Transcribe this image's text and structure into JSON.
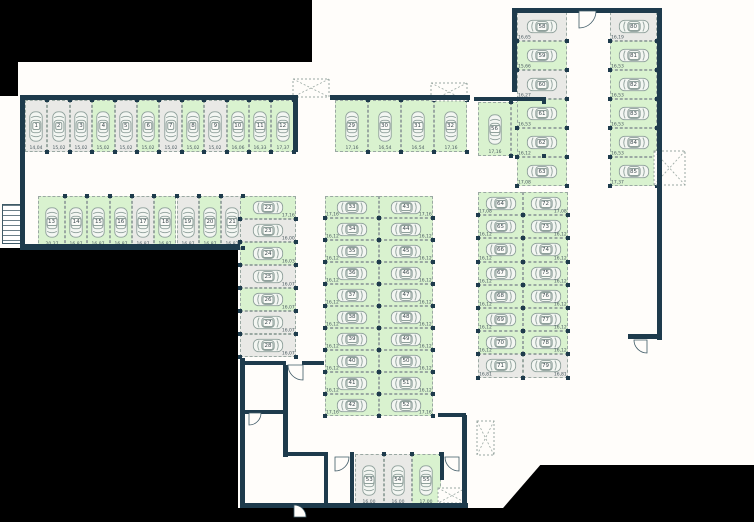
{
  "title": "Parking garage floor plan",
  "colors": {
    "available_fill": "#d9f2cf",
    "taken_fill": "#e9e9e6",
    "wall": "#1e3b4c",
    "background": "#000000",
    "floor": "#fffdfa",
    "car_outline": "#8fa09b"
  },
  "blocks": [
    {
      "id": "row-top-left",
      "spaces": [
        {
          "n": "1",
          "dim": "14,04",
          "state": "gray"
        },
        {
          "n": "2",
          "dim": "15,02",
          "state": "gray"
        },
        {
          "n": "3",
          "dim": "15,02",
          "state": "gray"
        },
        {
          "n": "4",
          "dim": "15,02",
          "state": "green"
        },
        {
          "n": "5",
          "dim": "15,02",
          "state": "gray"
        },
        {
          "n": "6",
          "dim": "15,02",
          "state": "green"
        },
        {
          "n": "7",
          "dim": "15,02",
          "state": "gray"
        },
        {
          "n": "8",
          "dim": "15,02",
          "state": "green"
        },
        {
          "n": "9",
          "dim": "15,02",
          "state": "gray"
        },
        {
          "n": "10",
          "dim": "16,06",
          "state": "green"
        },
        {
          "n": "11",
          "dim": "16,33",
          "state": "green"
        },
        {
          "n": "12",
          "dim": "17,37",
          "state": "green"
        }
      ]
    },
    {
      "id": "row-2",
      "spaces": [
        {
          "n": "13",
          "dim": "20,27",
          "state": "green"
        },
        {
          "n": "14",
          "dim": "16,87",
          "state": "green"
        },
        {
          "n": "15",
          "dim": "16,87",
          "state": "green"
        },
        {
          "n": "16",
          "dim": "16,87",
          "state": "green"
        },
        {
          "n": "17",
          "dim": "16,87",
          "state": "gray"
        },
        {
          "n": "18",
          "dim": "16,87",
          "state": "green"
        },
        {
          "n": "19",
          "dim": "16,87",
          "state": "gray"
        },
        {
          "n": "20",
          "dim": "16,87",
          "state": "green"
        },
        {
          "n": "21",
          "dim": "16,87",
          "state": "gray"
        }
      ]
    },
    {
      "id": "col-left",
      "spaces": [
        {
          "n": "22",
          "dim": "17,16",
          "state": "green"
        },
        {
          "n": "23",
          "dim": "16,00",
          "state": "gray"
        },
        {
          "n": "24",
          "dim": "16,03",
          "state": "green"
        },
        {
          "n": "25",
          "dim": "16,07",
          "state": "gray"
        },
        {
          "n": "26",
          "dim": "16,07",
          "state": "green"
        },
        {
          "n": "27",
          "dim": "16,07",
          "state": "gray"
        },
        {
          "n": "28",
          "dim": "16,07",
          "state": "gray"
        }
      ]
    },
    {
      "id": "row-mid",
      "spaces": [
        {
          "n": "29",
          "dim": "17,16",
          "state": "green"
        },
        {
          "n": "30",
          "dim": "16,54",
          "state": "green"
        },
        {
          "n": "31",
          "dim": "16,54",
          "state": "green"
        },
        {
          "n": "32",
          "dim": "17,16",
          "state": "green"
        }
      ]
    },
    {
      "id": "col-center-a",
      "spaces": [
        {
          "n": "33",
          "dim": "17,16",
          "state": "green"
        },
        {
          "n": "34",
          "dim": "16,12",
          "state": "green"
        },
        {
          "n": "35",
          "dim": "16,12",
          "state": "green"
        },
        {
          "n": "36",
          "dim": "16,12",
          "state": "green"
        },
        {
          "n": "37",
          "dim": "16,12",
          "state": "green"
        },
        {
          "n": "38",
          "dim": "16,12",
          "state": "green"
        },
        {
          "n": "39",
          "dim": "16,12",
          "state": "green"
        },
        {
          "n": "40",
          "dim": "16,12",
          "state": "green"
        },
        {
          "n": "41",
          "dim": "16,12",
          "state": "green"
        },
        {
          "n": "42",
          "dim": "17,16",
          "state": "green"
        }
      ]
    },
    {
      "id": "col-center-b",
      "spaces": [
        {
          "n": "43",
          "dim": "17,16",
          "state": "green"
        },
        {
          "n": "44",
          "dim": "16,12",
          "state": "green"
        },
        {
          "n": "45",
          "dim": "16,12",
          "state": "green"
        },
        {
          "n": "46",
          "dim": "16,12",
          "state": "green"
        },
        {
          "n": "47",
          "dim": "16,12",
          "state": "green"
        },
        {
          "n": "48",
          "dim": "16,12",
          "state": "green"
        },
        {
          "n": "49",
          "dim": "16,12",
          "state": "green"
        },
        {
          "n": "50",
          "dim": "16,12",
          "state": "green"
        },
        {
          "n": "51",
          "dim": "16,12",
          "state": "green"
        },
        {
          "n": "52",
          "dim": "17,16",
          "state": "green"
        }
      ]
    },
    {
      "id": "row-bottom",
      "spaces": [
        {
          "n": "53",
          "dim": "16,00",
          "state": "gray"
        },
        {
          "n": "54",
          "dim": "16,00",
          "state": "gray"
        },
        {
          "n": "55",
          "dim": "17,00",
          "state": "green"
        }
      ]
    },
    {
      "id": "pair-56-57",
      "spaces": [
        {
          "n": "56",
          "dim": "17,16",
          "state": "green"
        },
        {
          "n": "57",
          "dim": "16,54",
          "state": "green"
        }
      ]
    },
    {
      "id": "col-tr-left",
      "spaces": [
        {
          "n": "58",
          "dim": "16,65",
          "state": "gray"
        },
        {
          "n": "59",
          "dim": "15,66",
          "state": "green"
        },
        {
          "n": "60",
          "dim": "16,27",
          "state": "gray"
        },
        {
          "n": "61",
          "dim": "16,53",
          "state": "green"
        },
        {
          "n": "62",
          "dim": "16,12",
          "state": "green"
        },
        {
          "n": "63",
          "dim": "17,08",
          "state": "green"
        }
      ]
    },
    {
      "id": "col-tr-right",
      "spaces": [
        {
          "n": "80",
          "dim": "16,19",
          "state": "gray"
        },
        {
          "n": "81",
          "dim": "16,53",
          "state": "green"
        },
        {
          "n": "82",
          "dim": "16,53",
          "state": "green"
        },
        {
          "n": "83",
          "dim": "16,53",
          "state": "green"
        },
        {
          "n": "84",
          "dim": "16,53",
          "state": "green"
        },
        {
          "n": "85",
          "dim": "17,37",
          "state": "green"
        }
      ]
    },
    {
      "id": "col-right-a",
      "spaces": [
        {
          "n": "64",
          "dim": "17,08",
          "state": "green"
        },
        {
          "n": "65",
          "dim": "16,12",
          "state": "green"
        },
        {
          "n": "66",
          "dim": "16,12",
          "state": "green"
        },
        {
          "n": "67",
          "dim": "16,12",
          "state": "green"
        },
        {
          "n": "68",
          "dim": "16,12",
          "state": "green"
        },
        {
          "n": "69",
          "dim": "16,12",
          "state": "green"
        },
        {
          "n": "70",
          "dim": "16,12",
          "state": "green"
        },
        {
          "n": "71",
          "dim": "16,81",
          "state": "gray"
        }
      ]
    },
    {
      "id": "col-right-b",
      "spaces": [
        {
          "n": "72",
          "dim": "17,08",
          "state": "green"
        },
        {
          "n": "73",
          "dim": "16,12",
          "state": "green"
        },
        {
          "n": "74",
          "dim": "16,12",
          "state": "green"
        },
        {
          "n": "75",
          "dim": "16,12",
          "state": "green"
        },
        {
          "n": "76",
          "dim": "16,12",
          "state": "green"
        },
        {
          "n": "77",
          "dim": "16,12",
          "state": "green"
        },
        {
          "n": "78",
          "dim": "16,12",
          "state": "green"
        },
        {
          "n": "79",
          "dim": "16,81",
          "state": "gray"
        }
      ]
    }
  ]
}
